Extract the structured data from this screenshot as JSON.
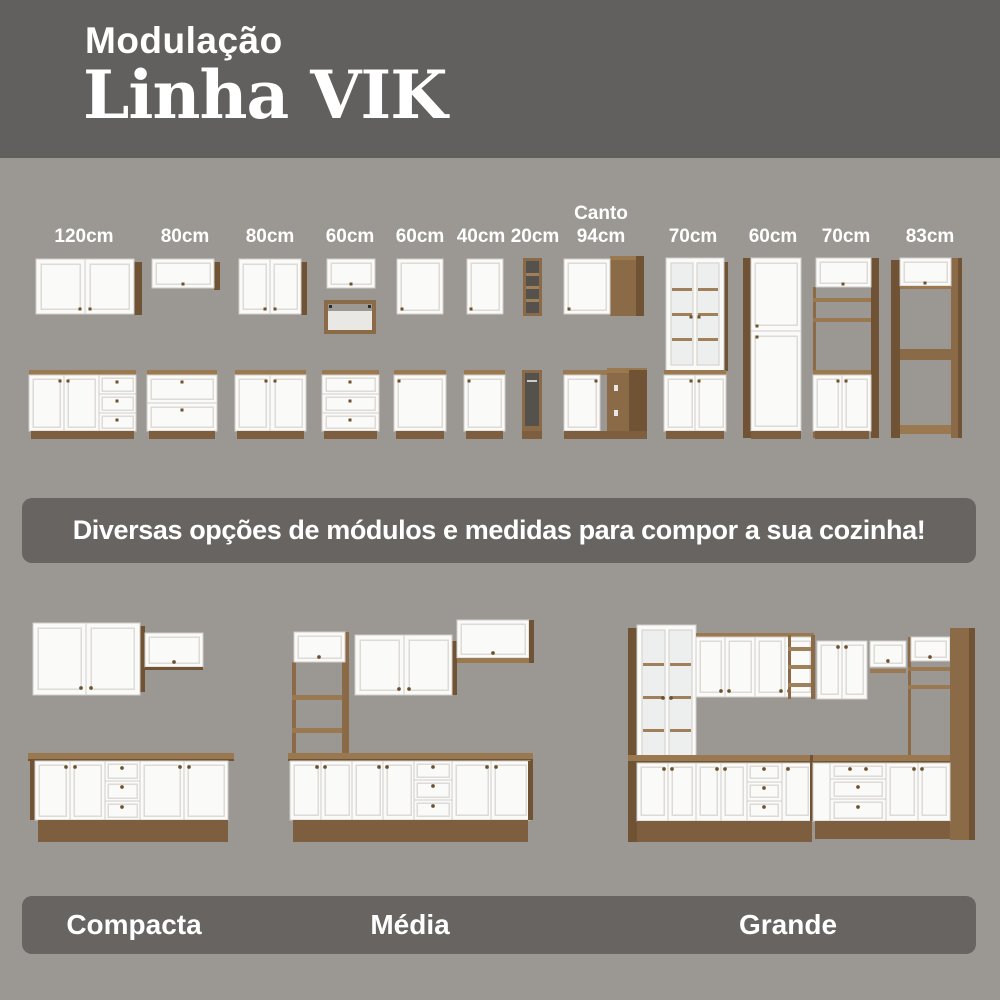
{
  "header": {
    "kicker": "Modulação",
    "title": "Linha VIK"
  },
  "modules": [
    {
      "label": "120cm"
    },
    {
      "label": "80cm"
    },
    {
      "label": "80cm"
    },
    {
      "label": "60cm"
    },
    {
      "label": "60cm"
    },
    {
      "label": "40cm"
    },
    {
      "label": "20cm"
    },
    {
      "prefix": "Canto",
      "label": "94cm"
    },
    {
      "label": "70cm"
    },
    {
      "label": "60cm"
    },
    {
      "label": "70cm"
    },
    {
      "label": "83cm"
    }
  ],
  "tagline": {
    "text": "Diversas opções de módulos e medidas para compor a sua cozinha!"
  },
  "kitchens": [
    {
      "name": "Compacta"
    },
    {
      "name": "Média"
    },
    {
      "name": "Grande"
    }
  ],
  "colors": {
    "header_bg": "#62605e",
    "page_bg": "#9b9793",
    "banner_bg": "#676461",
    "text": "#ffffff",
    "wood": "#8a6a47",
    "wood_dark": "#6f5334",
    "wood_light": "#9a7850",
    "cabinet_white": "#fafaf9"
  }
}
